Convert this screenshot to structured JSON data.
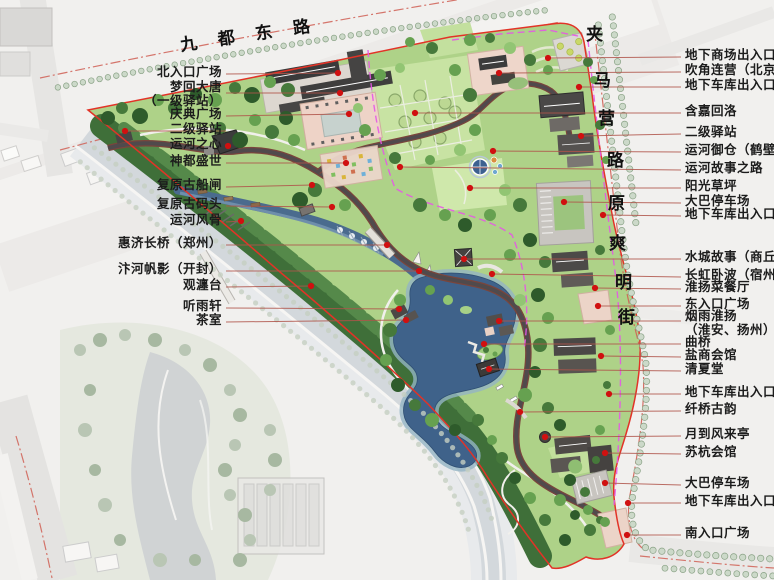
{
  "plan": {
    "roads": {
      "top": "九都东路",
      "right_chars": [
        "夹",
        "马",
        "营",
        "路",
        "原",
        "爽",
        "明",
        "街"
      ]
    }
  },
  "left_labels": [
    {
      "lines": [
        "北入口广场"
      ],
      "y": 74,
      "dot": [
        338,
        73
      ]
    },
    {
      "lines": [
        "梦回大唐",
        "（一级驿站）"
      ],
      "y": 89,
      "ay": 93,
      "dot": [
        340,
        93
      ]
    },
    {
      "lines": [
        "庆典广场"
      ],
      "y": 116,
      "dot": [
        349,
        114
      ]
    },
    {
      "lines": [
        "二级驿站"
      ],
      "y": 131,
      "dot": [
        125,
        131
      ]
    },
    {
      "lines": [
        "运河之心"
      ],
      "y": 146,
      "dot": [
        228,
        146
      ]
    },
    {
      "lines": [
        "神都盛世"
      ],
      "y": 163,
      "dot": [
        346,
        163
      ]
    },
    {
      "lines": [
        "复原古船闸"
      ],
      "y": 187,
      "dot": [
        312,
        185
      ]
    },
    {
      "lines": [
        "复原古码头"
      ],
      "y": 206,
      "dot": [
        332,
        207
      ]
    },
    {
      "lines": [
        "运河风骨"
      ],
      "y": 222,
      "dot": [
        241,
        221
      ]
    },
    {
      "lines": [
        "惠济长桥（郑州）"
      ],
      "y": 245,
      "dot": [
        387,
        245
      ]
    },
    {
      "lines": [
        "汴河帆影（开封）"
      ],
      "y": 271,
      "dot": [
        419,
        271
      ]
    },
    {
      "lines": [
        "观瀍台"
      ],
      "y": 287,
      "dot": [
        311,
        286
      ]
    },
    {
      "lines": [
        "听雨轩"
      ],
      "y": 308,
      "dot": [
        399,
        309
      ]
    },
    {
      "lines": [
        "茶室"
      ],
      "y": 322,
      "dot": [
        406,
        320
      ]
    }
  ],
  "right_labels": [
    {
      "lines": [
        "地下商场出入口"
      ],
      "y": 57,
      "dot": [
        548,
        58
      ]
    },
    {
      "lines": [
        "吹角连营（北京）"
      ],
      "y": 72,
      "dot": [
        499,
        73
      ]
    },
    {
      "lines": [
        "地下车库出入口"
      ],
      "y": 87,
      "dot": [
        579,
        87
      ]
    },
    {
      "lines": [
        "含嘉回洛"
      ],
      "y": 113,
      "dot": [
        415,
        113
      ]
    },
    {
      "lines": [
        "二级驿站"
      ],
      "y": 134,
      "dot": [
        581,
        136
      ]
    },
    {
      "lines": [
        "运河御仓（鹤壁）"
      ],
      "y": 152,
      "dot": [
        493,
        151
      ]
    },
    {
      "lines": [
        "运河故事之路"
      ],
      "y": 170,
      "dot": [
        400,
        167
      ]
    },
    {
      "lines": [
        "阳光草坪"
      ],
      "y": 188,
      "dot": [
        470,
        188
      ]
    },
    {
      "lines": [
        "大巴停车场"
      ],
      "y": 203,
      "dot": [
        564,
        202
      ]
    },
    {
      "lines": [
        "地下车库出入口"
      ],
      "y": 216,
      "dot": [
        603,
        215
      ]
    },
    {
      "lines": [
        "水城故事（商丘）"
      ],
      "y": 259,
      "dot": [
        464,
        259
      ]
    },
    {
      "lines": [
        "长虹卧波（宿州）"
      ],
      "y": 277,
      "dot": [
        492,
        274
      ]
    },
    {
      "lines": [
        "淮扬菜餐厅"
      ],
      "y": 289,
      "dot": [
        595,
        288
      ]
    },
    {
      "lines": [
        "东入口广场"
      ],
      "y": 306,
      "dot": [
        598,
        306
      ]
    },
    {
      "lines": [
        "烟雨淮扬",
        "（淮安、扬州）"
      ],
      "y": 318,
      "ay": 321,
      "dot": [
        499,
        321
      ]
    },
    {
      "lines": [
        "曲桥"
      ],
      "y": 344,
      "dot": [
        484,
        344
      ]
    },
    {
      "lines": [
        "盐商会馆"
      ],
      "y": 357,
      "dot": [
        601,
        356
      ]
    },
    {
      "lines": [
        "清夏堂"
      ],
      "y": 371,
      "dot": [
        489,
        369
      ]
    },
    {
      "lines": [
        "地下车库出入口"
      ],
      "y": 394,
      "dot": [
        609,
        394
      ]
    },
    {
      "lines": [
        "纤桥古韵"
      ],
      "y": 411,
      "dot": [
        520,
        412
      ]
    },
    {
      "lines": [
        "月到风来亭"
      ],
      "y": 436,
      "dot": [
        545,
        437
      ]
    },
    {
      "lines": [
        "苏杭会馆"
      ],
      "y": 454,
      "dot": [
        605,
        453
      ]
    },
    {
      "lines": [
        "大巴停车场"
      ],
      "y": 485,
      "dot": [
        605,
        483
      ]
    },
    {
      "lines": [
        "地下车库出入口"
      ],
      "y": 503,
      "dot": [
        628,
        503
      ]
    },
    {
      "lines": [
        "南入口广场"
      ],
      "y": 535,
      "dot": [
        627,
        535
      ]
    }
  ],
  "colors": {
    "boundary_red": "#e23327",
    "underground_magenta": "#e558e5",
    "feature_dot": "#d01010",
    "leader_line": "#b0544a",
    "lake_water": "#3f628a",
    "lawn": "#aed288",
    "forest": "#3f6f39",
    "story_road": "#504a4c",
    "plaza_pink": "#eed3c8"
  }
}
